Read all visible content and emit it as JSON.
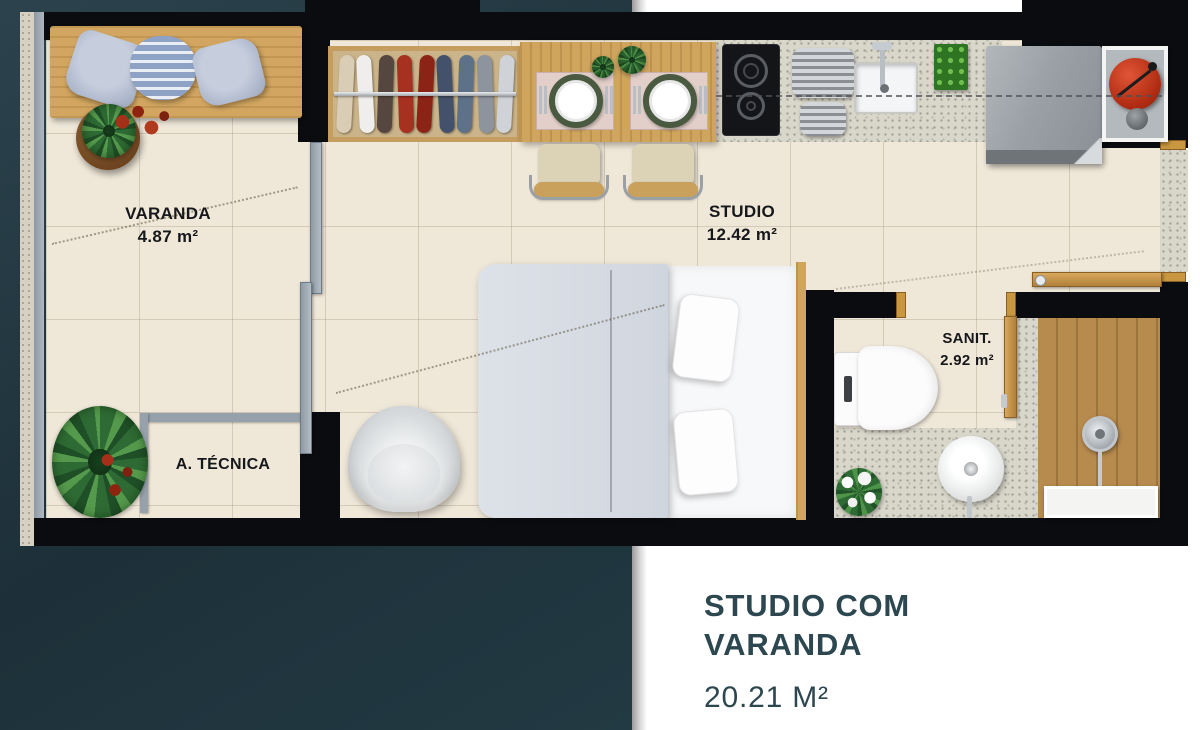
{
  "page": {
    "panel_color": "#20333C",
    "background_color": "#FFFFFF"
  },
  "floorplan": {
    "rooms": {
      "varanda": {
        "name": "VARANDA",
        "area": "4.87 m²"
      },
      "studio": {
        "name": "STUDIO",
        "area": "12.42 m²"
      },
      "sanit": {
        "name": "SANIT.",
        "area": "2.92 m²"
      },
      "tecnica": {
        "name": "A. TÉCNICA"
      }
    }
  },
  "caption": {
    "title_line1": "STUDIO COM",
    "title_line2": "VARANDA",
    "total_area": "20.21 M²",
    "text_color": "#2D4751"
  },
  "colors": {
    "wall": "#0B0C10",
    "floor_tile": "#EFE7D8",
    "wood": "#CFA55E",
    "granite": "#D9D6CA",
    "glass": "#9AA5B0",
    "accent_red": "#B02C12",
    "plant_green": "#3F7D3A",
    "label_color": "#17181C"
  }
}
